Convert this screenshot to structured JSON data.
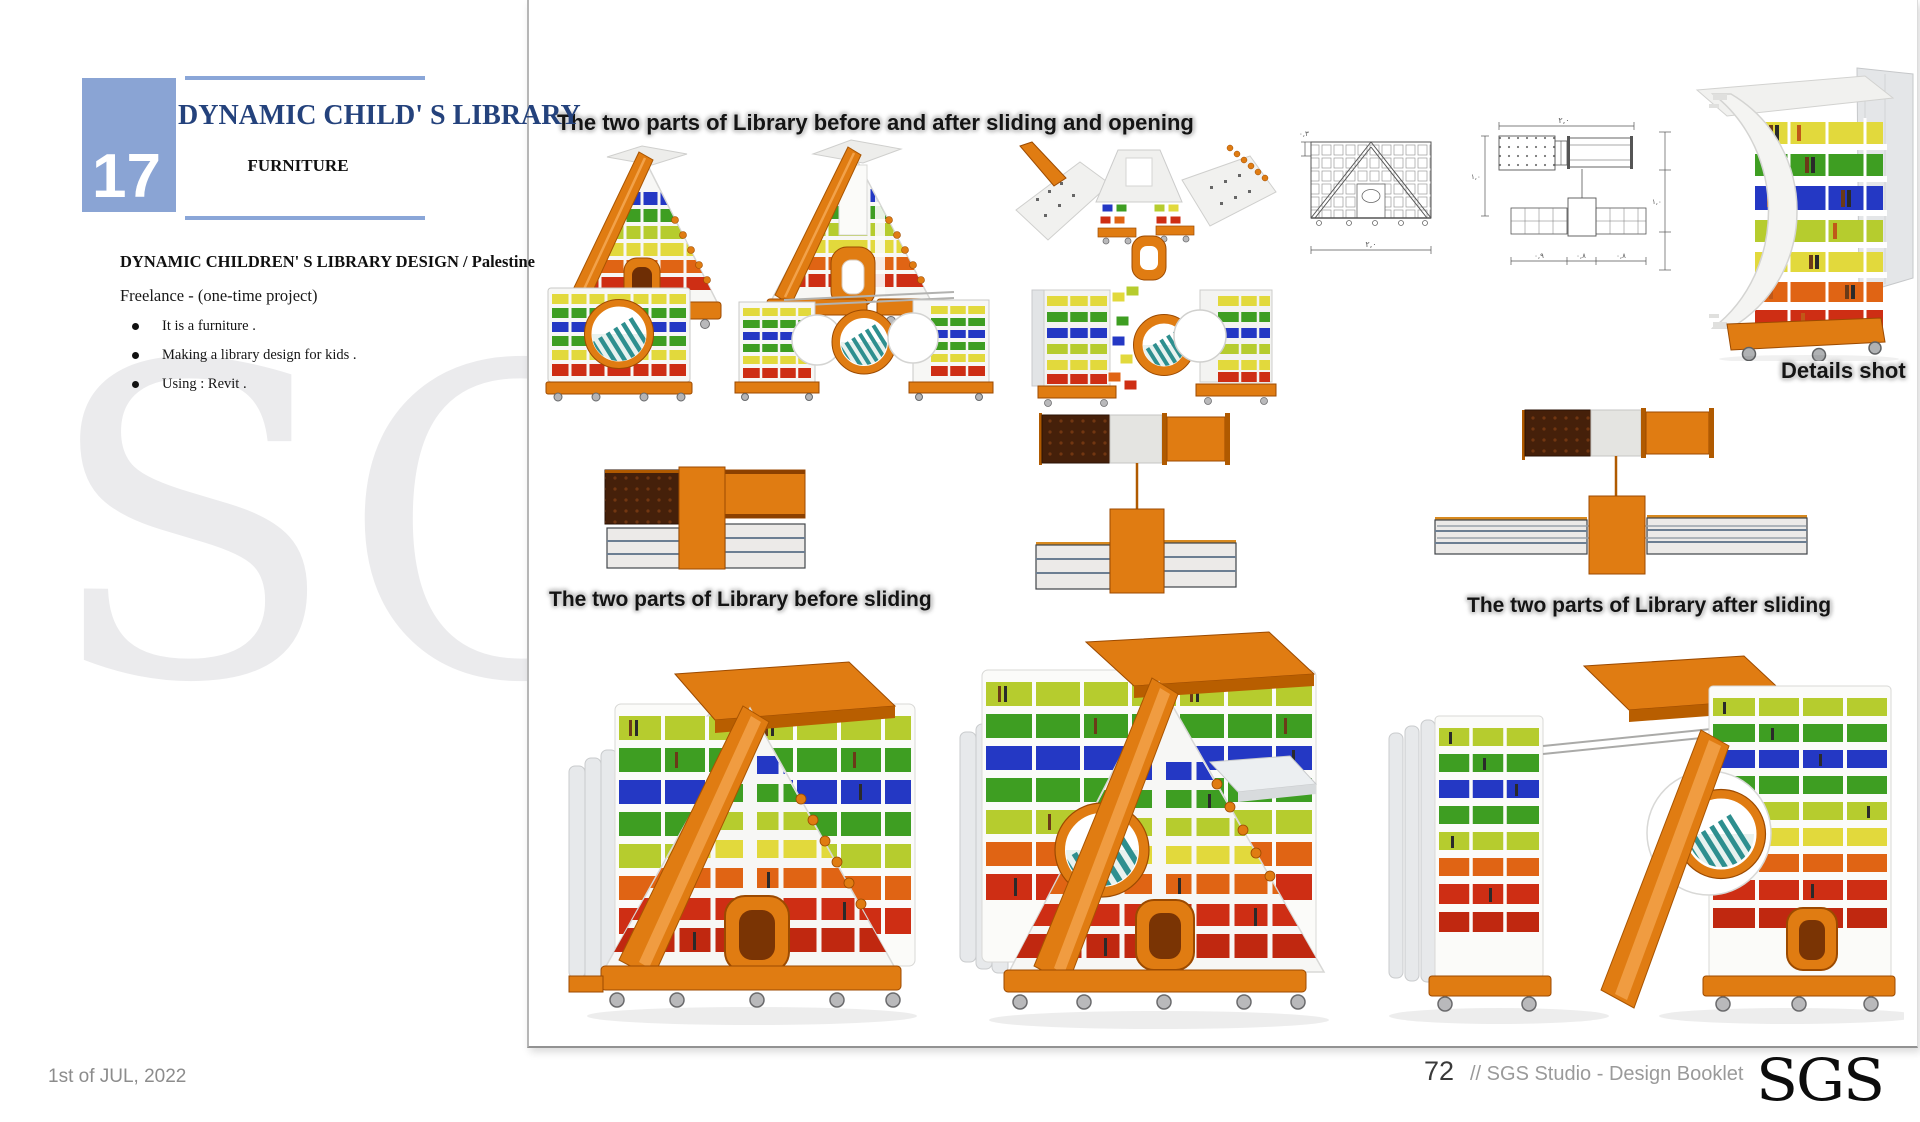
{
  "page": {
    "number_box": "17",
    "title": "DYNAMIC CHILD' S LIBRARY",
    "subtitle": "FURNITURE",
    "project_heading": "DYNAMIC CHILDREN' S LIBRARY DESIGN  / Palestine",
    "project_type": "Freelance -   (one-time project)",
    "bullets": [
      "It is  a furniture .",
      "Making  a library design for kids .",
      "Using : Revit ."
    ],
    "watermark": "SGS"
  },
  "captions": {
    "top": "The two parts of Library before and after sliding and opening",
    "details": "Details shot",
    "before": "The two parts of Library before sliding",
    "after": "The two parts of Library after sliding"
  },
  "drawings": {
    "front_width": "٢,٠",
    "front_offset": "٠,٣",
    "plan_width": "٢,٠",
    "plan_height": "١,٠",
    "plan_d1": "٠,٩",
    "plan_d2": "٠,٨",
    "plan_d3": "٠,٨",
    "side_height": "١,٠"
  },
  "footer": {
    "date": "1st of JUL, 2022",
    "page_number": "72",
    "studio": "// SGS Studio - Design Booklet",
    "logo": "SGS"
  },
  "colors": {
    "accent_navy": "#24427C",
    "line_blue": "#8AA6D8",
    "box_blue": "#8AA4D4",
    "orange": "#E07C12",
    "orange_dark": "#9C4A00",
    "orange_hl": "#F2A24A",
    "brown": "#45200A",
    "blue": "#2438C4",
    "green": "#3E9E22",
    "ygreen": "#B6CC2E",
    "yellow": "#E2D93C",
    "red": "#CE2E14",
    "red_orange": "#E06414",
    "teal": "#2E8F8F",
    "shelf_white": "#F7F7F5",
    "frame_gray": "#E7E9EB",
    "stroke_gray": "#D6D6D4",
    "slab": "#ECEAE8",
    "slab_line": "#6C7E92",
    "cad": "#5A5A5A",
    "text_gray": "#8C8C8C",
    "footer_dark": "#3A3A3A",
    "watermark": "#EBEBED",
    "halo": "#D2D2D2"
  }
}
